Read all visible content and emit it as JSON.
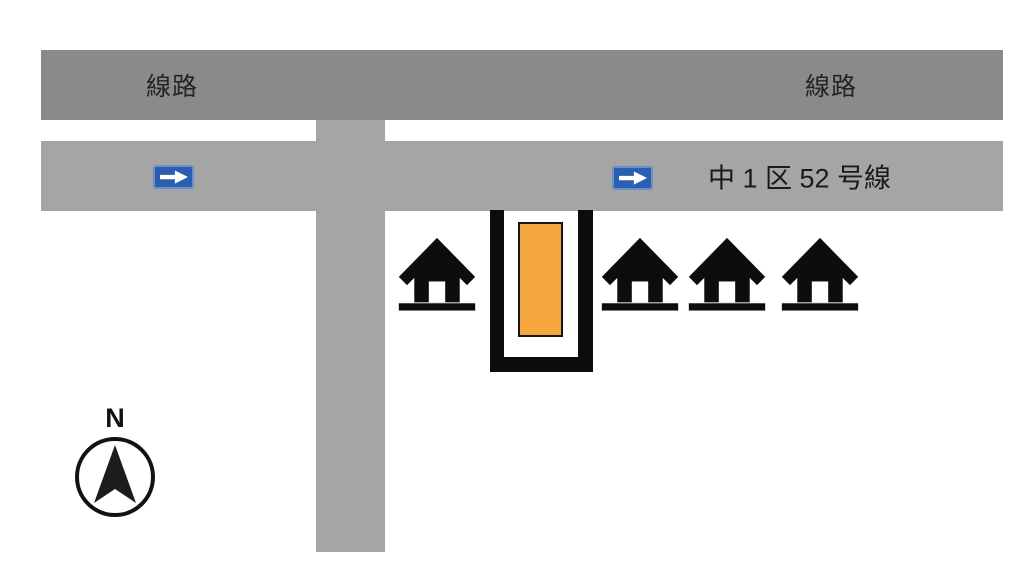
{
  "railway": {
    "left_label": "線路",
    "right_label": "線路"
  },
  "road": {
    "name_label": "中 1 区 52 号線",
    "oneway_sign_count": 2
  },
  "compass": {
    "north_label": "N"
  },
  "houses": {
    "count": 4
  },
  "colors": {
    "railway_gray": "#8a8a8a",
    "road_gray": "#a5a5a5",
    "target_building_orange": "#f3a73c",
    "oneway_sign_blue": "#2a5fb0",
    "icon_black": "#0d0d0d",
    "background": "#ffffff"
  },
  "icons": {
    "oneway_arrow": "→",
    "house": "⌂",
    "north_arrow": "▲"
  }
}
